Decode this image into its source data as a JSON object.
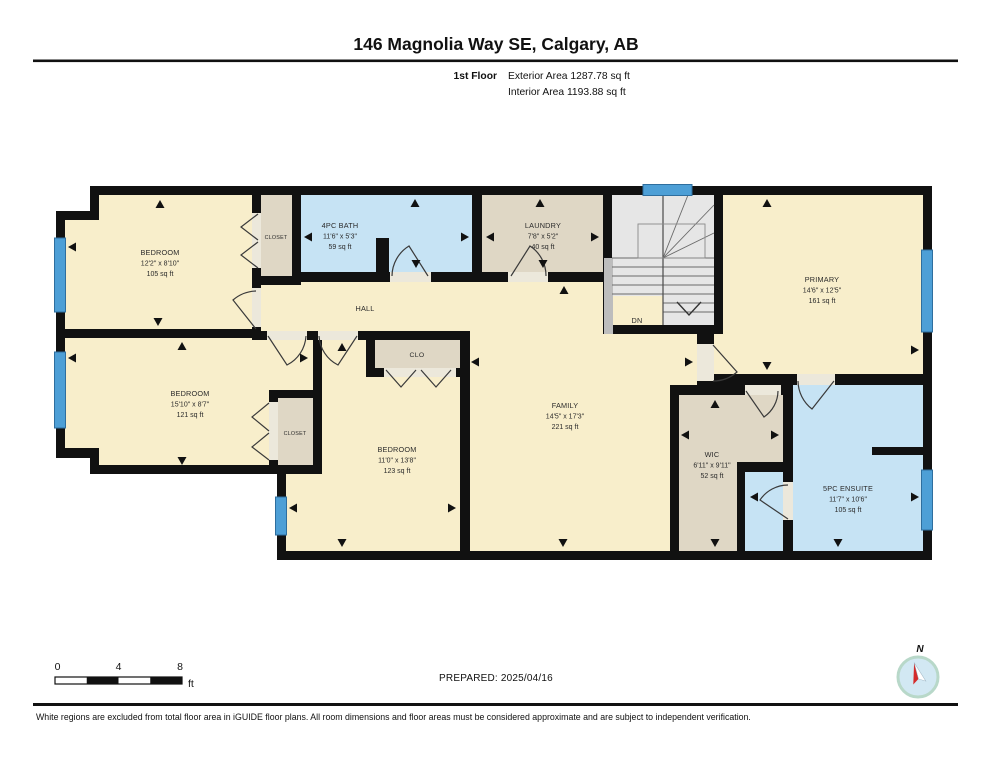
{
  "header": {
    "title": "146 Magnolia Way SE, Calgary, AB",
    "floor_label": "1st Floor",
    "exterior_area": "Exterior Area 1287.78 sq ft",
    "interior_area": "Interior Area 1193.88 sq ft"
  },
  "rooms": {
    "bedroom1": {
      "name": "BEDROOM",
      "dims": "12'2\" x 8'10\"",
      "area": "105 sq ft"
    },
    "closet1": {
      "name": "CLOSET"
    },
    "bath": {
      "name": "4PC BATH",
      "dims": "11'6\" x 5'3\"",
      "area": "59 sq ft"
    },
    "laundry": {
      "name": "LAUNDRY",
      "dims": "7'8\" x 5'2\"",
      "area": "40 sq ft"
    },
    "hall": {
      "name": "HALL"
    },
    "stairs": {
      "name": "DN"
    },
    "primary": {
      "name": "PRIMARY",
      "dims": "14'6\" x 12'5\"",
      "area": "161 sq ft"
    },
    "bedroom2": {
      "name": "BEDROOM",
      "dims": "15'10\" x 8'7\"",
      "area": "121 sq ft"
    },
    "closet2": {
      "name": "CLOSET"
    },
    "clo": {
      "name": "CLO"
    },
    "bedroom3": {
      "name": "BEDROOM",
      "dims": "11'0\" x 13'8\"",
      "area": "123 sq ft"
    },
    "family": {
      "name": "FAMILY",
      "dims": "14'5\" x 17'3\"",
      "area": "221 sq ft"
    },
    "wic": {
      "name": "WIC",
      "dims": "6'11\" x 9'11\"",
      "area": "52 sq ft"
    },
    "ensuite": {
      "name": "5PC ENSUITE",
      "dims": "11'7\" x 10'6\"",
      "area": "105 sq ft"
    }
  },
  "scale_bar": {
    "tick0": "0",
    "tick4": "4",
    "tick8": "8",
    "unit": "ft"
  },
  "footer": {
    "prepared": "PREPARED: 2025/04/16",
    "north_label": "N",
    "disclaimer": "White regions are excluded from total floor area in iGUIDE floor plans. All room dimensions and floor areas must be considered approximate and are subject to independent verification."
  },
  "colors": {
    "wall": "#111111",
    "floor_cream": "#F8EECB",
    "floor_blue": "#C6E3F4",
    "floor_tan": "#DFD7C5",
    "floor_stairs": "#E6E6E6",
    "window": "#4D9FD6",
    "door_gap": "#ECE8DB",
    "needle_red": "#D42B2B"
  }
}
